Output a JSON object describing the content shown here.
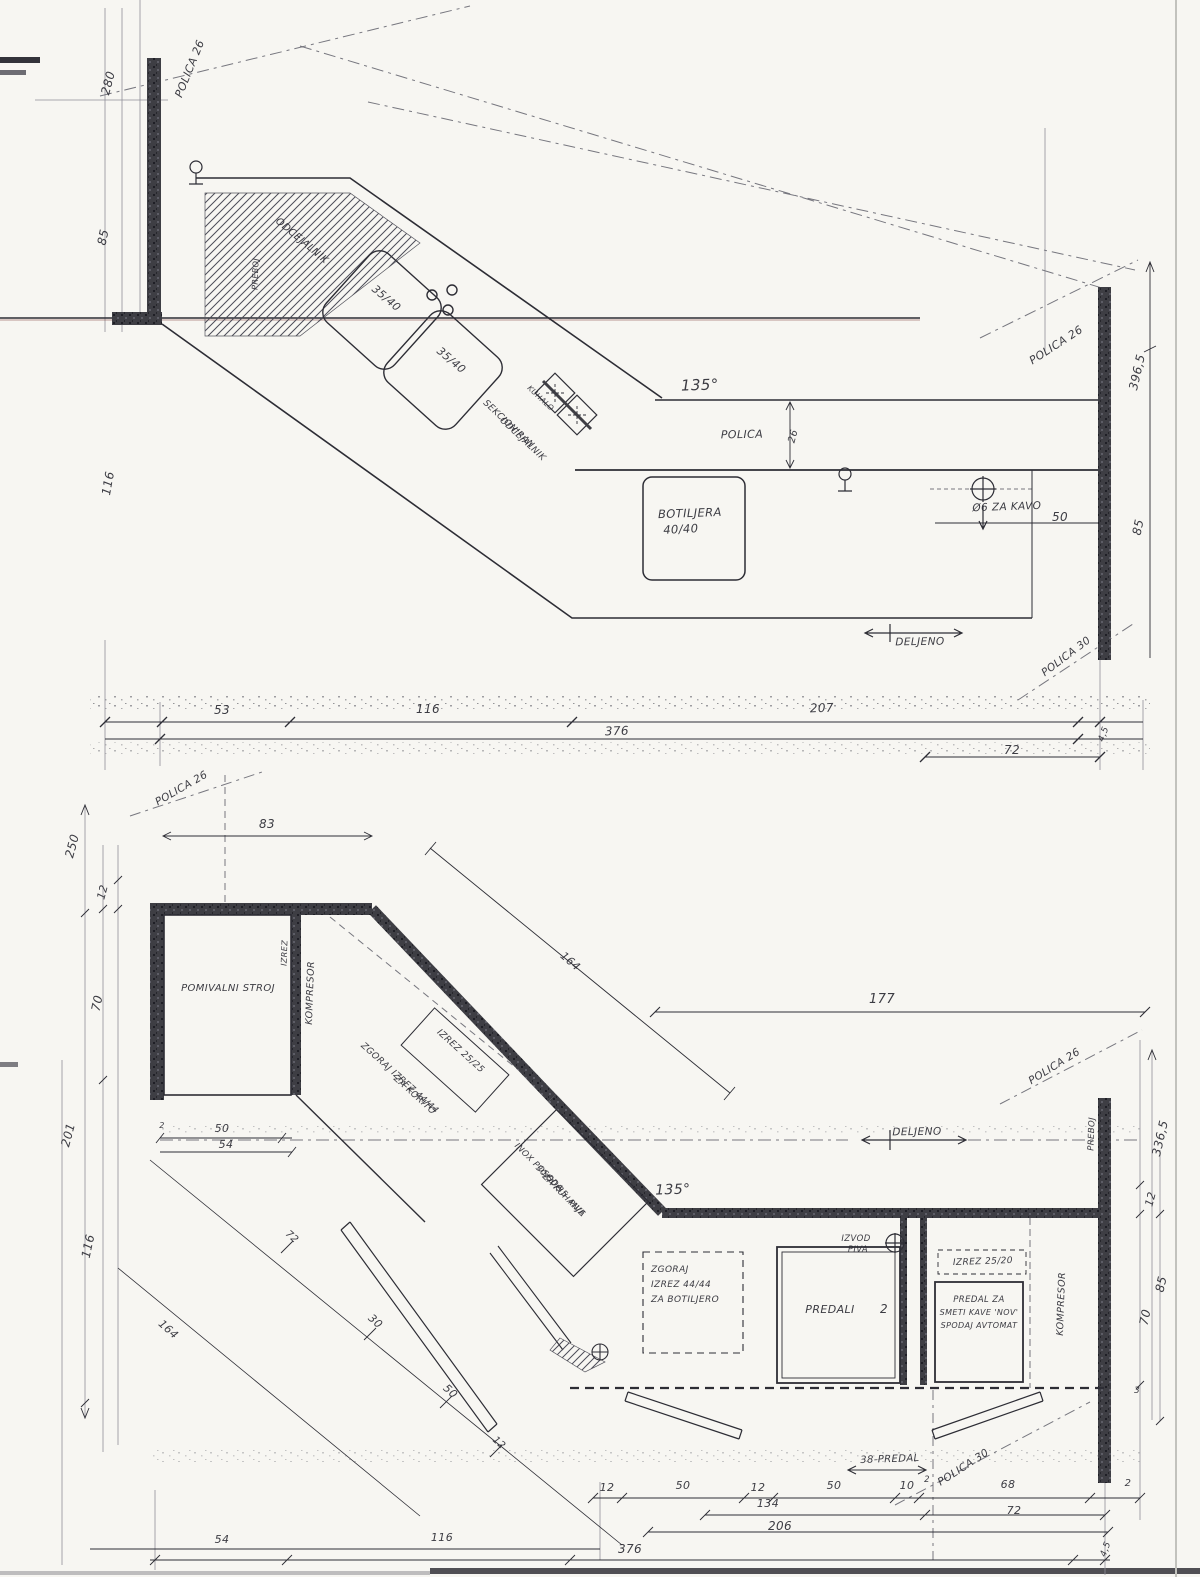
{
  "page": {
    "background": "#f7f6f2",
    "ink": "#2d2d35",
    "wall_color": "#3e3e44",
    "light_line": "#8f8f98",
    "scan_red": "#8a4a42"
  },
  "top_plan": {
    "labels": [
      {
        "t": "POLICA 26",
        "x": 193,
        "y": 70,
        "r": -68,
        "s": 11
      },
      {
        "t": "280",
        "x": 112,
        "y": 84,
        "r": -75,
        "s": 12
      },
      {
        "t": "85",
        "x": 107,
        "y": 238,
        "r": -78,
        "s": 12
      },
      {
        "t": "PREBOJ",
        "x": 258,
        "y": 274,
        "r": -88,
        "s": 8
      },
      {
        "t": "116",
        "x": 112,
        "y": 484,
        "r": -80,
        "s": 12
      },
      {
        "t": "ODCEJALNIK",
        "x": 300,
        "y": 243,
        "r": 40,
        "s": 10
      },
      {
        "t": "35/40",
        "x": 384,
        "y": 301,
        "r": 40,
        "s": 11
      },
      {
        "t": "35/40",
        "x": 449,
        "y": 363,
        "r": 40,
        "s": 11
      },
      {
        "t": "KUHALO",
        "x": 539,
        "y": 400,
        "r": 43,
        "s": 7.5
      },
      {
        "t": "SEKCIONIRAN",
        "x": 507,
        "y": 426,
        "r": 43,
        "s": 9
      },
      {
        "t": "ODCEJALNIK",
        "x": 521,
        "y": 441,
        "r": 43,
        "s": 9
      },
      {
        "t": "135°",
        "x": 700,
        "y": 390,
        "r": -2,
        "s": 15
      },
      {
        "t": "POLICA",
        "x": 742,
        "y": 438,
        "r": -1,
        "s": 11
      },
      {
        "t": "26",
        "x": 796,
        "y": 437,
        "r": -75,
        "s": 10
      },
      {
        "t": "BOTILJERA",
        "x": 690,
        "y": 517,
        "r": -2,
        "s": 11.5
      },
      {
        "t": "40/40",
        "x": 681,
        "y": 533,
        "r": -3,
        "s": 11.5
      },
      {
        "t": "POLICA 26",
        "x": 1058,
        "y": 348,
        "r": -33,
        "s": 11
      },
      {
        "t": "396,5",
        "x": 1141,
        "y": 373,
        "r": -77,
        "s": 12
      },
      {
        "t": "Ø6 ZA KAVO",
        "x": 1007,
        "y": 510,
        "r": -2,
        "s": 10.5
      },
      {
        "t": "50",
        "x": 1060,
        "y": 521,
        "r": 0,
        "s": 12
      },
      {
        "t": "85",
        "x": 1142,
        "y": 528,
        "r": -78,
        "s": 12
      },
      {
        "t": "DELJENO",
        "x": 920,
        "y": 645,
        "r": -1,
        "s": 10.5
      },
      {
        "t": "POLICA 30",
        "x": 1068,
        "y": 659,
        "r": -37,
        "s": 10.5
      },
      {
        "t": "53",
        "x": 222,
        "y": 714,
        "r": 0,
        "s": 12
      },
      {
        "t": "116",
        "x": 428,
        "y": 713,
        "r": 0,
        "s": 12
      },
      {
        "t": "207",
        "x": 822,
        "y": 712,
        "r": -2,
        "s": 12
      },
      {
        "t": "376",
        "x": 617,
        "y": 735,
        "r": -2,
        "s": 12
      },
      {
        "t": "72",
        "x": 1012,
        "y": 754,
        "r": 0,
        "s": 12
      },
      {
        "t": "4,5",
        "x": 1106,
        "y": 735,
        "r": -70,
        "s": 9
      }
    ]
  },
  "bottom_plan": {
    "labels": [
      {
        "t": "POLICA 26",
        "x": 183,
        "y": 791,
        "r": -30,
        "s": 10.5
      },
      {
        "t": "83",
        "x": 267,
        "y": 828,
        "r": 0,
        "s": 12
      },
      {
        "t": "250",
        "x": 76,
        "y": 847,
        "r": -75,
        "s": 12
      },
      {
        "t": "12",
        "x": 106,
        "y": 893,
        "r": -75,
        "s": 11
      },
      {
        "t": "70",
        "x": 101,
        "y": 1004,
        "r": -78,
        "s": 12
      },
      {
        "t": "POMIVALNI  STROJ",
        "x": 228,
        "y": 991,
        "r": 0,
        "s": 10
      },
      {
        "t": "IZREZ",
        "x": 287,
        "y": 953,
        "r": -88,
        "s": 8
      },
      {
        "t": "KOMPRESOR",
        "x": 313,
        "y": 993,
        "r": -88,
        "s": 9.5
      },
      {
        "t": "ZGORAJ IZREZ 44/44",
        "x": 398,
        "y": 1080,
        "r": 42,
        "s": 9
      },
      {
        "t": "ZA KORITO",
        "x": 413,
        "y": 1097,
        "r": 42,
        "s": 9
      },
      {
        "t": "IZREZ 25/25",
        "x": 459,
        "y": 1053,
        "r": 42,
        "s": 9
      },
      {
        "t": "164",
        "x": 568,
        "y": 964,
        "r": 41,
        "s": 11
      },
      {
        "t": "177",
        "x": 882,
        "y": 1003,
        "r": 0,
        "s": 13
      },
      {
        "t": "POLICA 26",
        "x": 1056,
        "y": 1069,
        "r": -32,
        "s": 10.5
      },
      {
        "t": "DELJENO",
        "x": 917,
        "y": 1135,
        "r": -1,
        "s": 10.5
      },
      {
        "t": "PREBOJ",
        "x": 1094,
        "y": 1134,
        "r": -88,
        "s": 8.5
      },
      {
        "t": "336,5",
        "x": 1164,
        "y": 1139,
        "r": -77,
        "s": 12
      },
      {
        "t": "50",
        "x": 222,
        "y": 1132,
        "r": 0,
        "s": 11
      },
      {
        "t": "54",
        "x": 226,
        "y": 1148,
        "r": 0,
        "s": 11
      },
      {
        "t": "2",
        "x": 162,
        "y": 1128,
        "r": 0,
        "s": 8
      },
      {
        "t": "201",
        "x": 72,
        "y": 1136,
        "r": -75,
        "s": 12
      },
      {
        "t": "116",
        "x": 92,
        "y": 1247,
        "r": -78,
        "s": 12
      },
      {
        "t": "INOX POSODA",
        "x": 537,
        "y": 1169,
        "r": 45,
        "s": 8.5
      },
      {
        "t": "30/50/35",
        "x": 550,
        "y": 1183,
        "r": 45,
        "s": 8.5
      },
      {
        "t": "ZA KUHANJE",
        "x": 562,
        "y": 1197,
        "r": 45,
        "s": 8.5
      },
      {
        "t": "PIVA",
        "x": 575,
        "y": 1210,
        "r": 45,
        "s": 8.5
      },
      {
        "t": "135°",
        "x": 673,
        "y": 1194,
        "r": -2,
        "s": 14
      },
      {
        "t": "IZVOD",
        "x": 856,
        "y": 1241,
        "r": 0,
        "s": 8.5
      },
      {
        "t": "PIVA",
        "x": 858,
        "y": 1252,
        "r": 0,
        "s": 8.5
      },
      {
        "t": "ZGORAJ",
        "x": 651,
        "y": 1272,
        "r": 0,
        "s": 9,
        "a": "start"
      },
      {
        "t": "IZREZ 44/44",
        "x": 651,
        "y": 1287,
        "r": 0,
        "s": 9,
        "a": "start"
      },
      {
        "t": "ZA BOTILJERO",
        "x": 651,
        "y": 1302,
        "r": 0,
        "s": 9,
        "a": "start"
      },
      {
        "t": "PREDALI",
        "x": 830,
        "y": 1313,
        "r": 0,
        "s": 11
      },
      {
        "t": "2",
        "x": 884,
        "y": 1313,
        "r": 0,
        "s": 12
      },
      {
        "t": "IZREZ 25/20",
        "x": 983,
        "y": 1264,
        "r": -2,
        "s": 9
      },
      {
        "t": "PREDAL ZA",
        "x": 979,
        "y": 1302,
        "r": 0,
        "s": 8.5
      },
      {
        "t": "SMETI KAVE 'NOV'",
        "x": 979,
        "y": 1315,
        "r": 0,
        "s": 8
      },
      {
        "t": "SPODAJ AVTOMAT",
        "x": 979,
        "y": 1328,
        "r": 0,
        "s": 8
      },
      {
        "t": "KOMPRESOR",
        "x": 1064,
        "y": 1304,
        "r": -88,
        "s": 9.5
      },
      {
        "t": "12",
        "x": 1154,
        "y": 1200,
        "r": -75,
        "s": 11
      },
      {
        "t": "85",
        "x": 1165,
        "y": 1285,
        "r": -77,
        "s": 12
      },
      {
        "t": "70",
        "x": 1149,
        "y": 1318,
        "r": -78,
        "s": 12
      },
      {
        "t": "3",
        "x": 1137,
        "y": 1393,
        "r": 0,
        "s": 9
      },
      {
        "t": "164",
        "x": 166,
        "y": 1332,
        "r": 42,
        "s": 11
      },
      {
        "t": "72",
        "x": 290,
        "y": 1239,
        "r": 42,
        "s": 10
      },
      {
        "t": "30",
        "x": 373,
        "y": 1324,
        "r": 42,
        "s": 11
      },
      {
        "t": "50",
        "x": 448,
        "y": 1394,
        "r": 42,
        "s": 11
      },
      {
        "t": "12",
        "x": 497,
        "y": 1445,
        "r": 42,
        "s": 10
      },
      {
        "t": "38-PREDAL",
        "x": 890,
        "y": 1462,
        "r": -2,
        "s": 10
      },
      {
        "t": "POLICA 30",
        "x": 965,
        "y": 1470,
        "r": -33,
        "s": 10.5
      },
      {
        "t": "12",
        "x": 607,
        "y": 1491,
        "r": 0,
        "s": 11
      },
      {
        "t": "50",
        "x": 683,
        "y": 1489,
        "r": 0,
        "s": 11
      },
      {
        "t": "12",
        "x": 758,
        "y": 1491,
        "r": 0,
        "s": 11
      },
      {
        "t": "134",
        "x": 768,
        "y": 1507,
        "r": 0,
        "s": 11
      },
      {
        "t": "50",
        "x": 834,
        "y": 1489,
        "r": 0,
        "s": 11
      },
      {
        "t": "10",
        "x": 907,
        "y": 1489,
        "r": 0,
        "s": 11
      },
      {
        "t": "2",
        "x": 927,
        "y": 1482,
        "r": 0,
        "s": 8.5
      },
      {
        "t": "68",
        "x": 1008,
        "y": 1488,
        "r": 0,
        "s": 11
      },
      {
        "t": "2",
        "x": 1128,
        "y": 1486,
        "r": 0,
        "s": 10
      },
      {
        "t": "72",
        "x": 1014,
        "y": 1514,
        "r": 0,
        "s": 11
      },
      {
        "t": "206",
        "x": 780,
        "y": 1530,
        "r": 0,
        "s": 12
      },
      {
        "t": "376",
        "x": 630,
        "y": 1553,
        "r": 0,
        "s": 12
      },
      {
        "t": "54",
        "x": 222,
        "y": 1543,
        "r": 0,
        "s": 11
      },
      {
        "t": "116",
        "x": 442,
        "y": 1541,
        "r": 0,
        "s": 11
      },
      {
        "t": "4,5",
        "x": 1108,
        "y": 1550,
        "r": -70,
        "s": 9
      }
    ]
  }
}
